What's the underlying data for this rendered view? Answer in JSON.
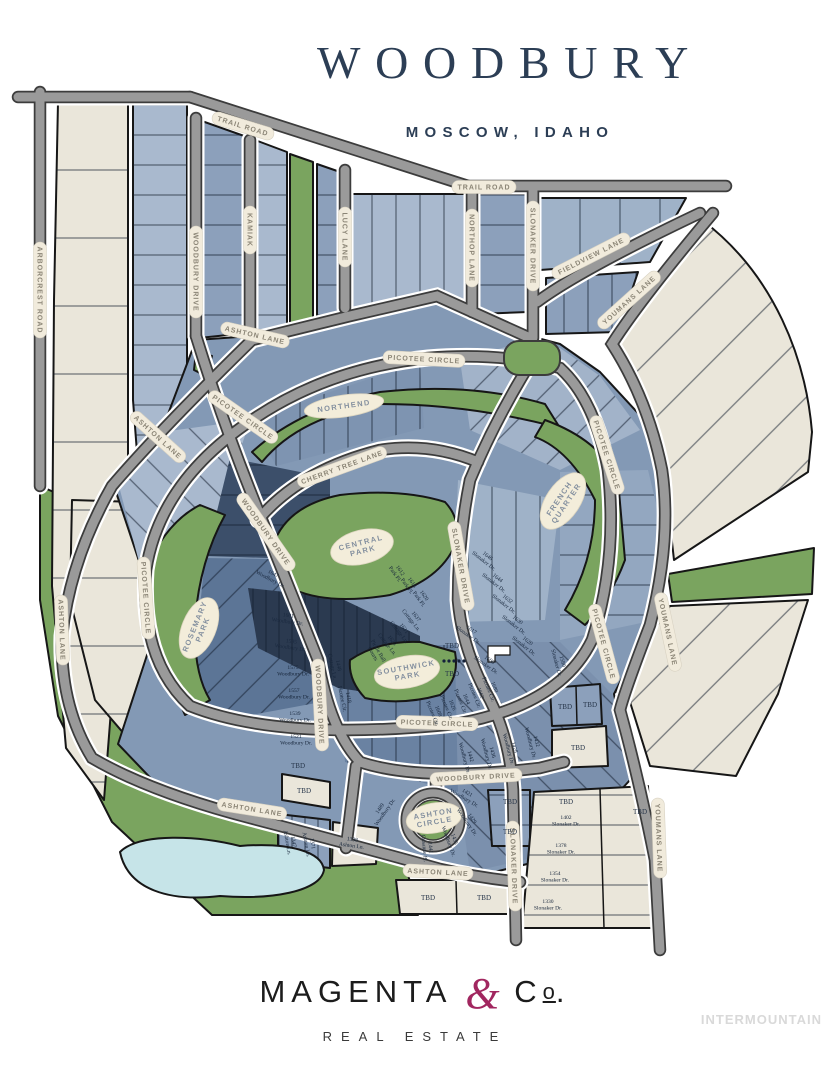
{
  "header": {
    "title": "WOODBURY",
    "location": "MOSCOW, IDAHO"
  },
  "brand": {
    "magenta": "MAGENTA",
    "amp": "&",
    "c": "C",
    "o": "o",
    "period": ".",
    "tagline": "REAL ESTATE"
  },
  "watermark": "INTERMOUNTAIN",
  "colors": {
    "navy_title": "#2c3e55",
    "magenta_accent": "#a1265f",
    "park_green": "#7aa45f",
    "cream_lot": "#eae6da",
    "road_gray": "#9a9a9a",
    "pond_blue": "#c6e4e8",
    "lot_blue_light": "#a9b9ce",
    "lot_blue_mid": "#8399b5",
    "lot_blue_dark": "#3c4f6a",
    "lot_blue_darkest": "#2b3a50"
  },
  "map": {
    "streets": [
      {
        "t": "TRAIL ROAD"
      },
      {
        "t": "TRAIL ROAD"
      },
      {
        "t": "ARBORCREST ROAD"
      },
      {
        "t": "WOODBURY DRIVE"
      },
      {
        "t": "KAMIAK"
      },
      {
        "t": "LUCY LANE"
      },
      {
        "t": "NORTHOP LANE"
      },
      {
        "t": "SLONAKER DRIVE"
      },
      {
        "t": "FIELDVIEW LANE"
      },
      {
        "t": "YOUMANS LANE"
      },
      {
        "t": "ASHTON LANE"
      },
      {
        "t": "ASHTON LANE"
      },
      {
        "t": "PICOTEE CIRCLE"
      },
      {
        "t": "PICOTEE CIRCLE"
      },
      {
        "t": "PICOTEE CIRCLE"
      },
      {
        "t": "PICOTEE CIRCLE"
      },
      {
        "t": "PICOTEE CIRCLE"
      },
      {
        "t": "PICOTEE CIRCLE"
      },
      {
        "t": "CHERRY TREE LANE"
      },
      {
        "t": "WOODBURY DRIVE"
      },
      {
        "t": "WOODBURY DRIVE"
      },
      {
        "t": "WOODBURY DRIVE"
      },
      {
        "t": "SLONAKER DRIVE"
      },
      {
        "t": "SLONAKER DRIVE"
      },
      {
        "t": "YOUMANS LANE"
      },
      {
        "t": "YOUMANS LANE"
      },
      {
        "t": "ASHTON LANE"
      },
      {
        "t": "ASHTON LANE"
      },
      {
        "t": "ASHTON LANE"
      }
    ],
    "parks": [
      {
        "t": "NORTHEND"
      },
      {
        "t": "CENTRAL\nPARK"
      },
      {
        "t": "FRENCH\nQUARTER"
      },
      {
        "t": "ROSEMARY\nPARK"
      },
      {
        "t": "SOUTHWICK\nPARK"
      },
      {
        "t": "ASHTON\nCIRCLE"
      }
    ],
    "lots": [
      {
        "t": "1647\nWoodbury Dr."
      },
      {
        "t": "1601\nWoodbury Dr."
      },
      {
        "t": "1595\nWoodbury Dr."
      },
      {
        "t": "1575\nWoodbury Dr."
      },
      {
        "t": "1557\nWoodbury Dr."
      },
      {
        "t": "1539\nWoodbury Dr."
      },
      {
        "t": "1521\nWoodbury Dr."
      },
      {
        "t": "TBD"
      },
      {
        "t": "1646\nSlonaker Dr."
      },
      {
        "t": "1644\nSlonaker Dr."
      },
      {
        "t": "1632\nSlonaker Dr."
      },
      {
        "t": "1630\nSlonaker Dr."
      },
      {
        "t": "1620\nSlonaker Dr."
      },
      {
        "t": "1617\nSlonaker Dr."
      },
      {
        "t": "1608\nSlonaker Dr."
      },
      {
        "t": "TBD"
      },
      {
        "t": "TBD"
      },
      {
        "t": "1612\nPark Pl."
      },
      {
        "t": "1616\nPark Pl."
      },
      {
        "t": "1620\nPark Pl."
      },
      {
        "t": "1637\nCottage Ln."
      },
      {
        "t": "1631\nCottage Ln."
      },
      {
        "t": "1625\nCottage Ln."
      },
      {
        "t": "Pickle Ball\nCourts"
      },
      {
        "t": "1448\nCottage Ln."
      },
      {
        "t": "1418\nPicotee Cir."
      },
      {
        "t": "1680\nPicotee Cir."
      },
      {
        "t": "1662\nPicotee Cir."
      },
      {
        "t": "1644\nPicotee Cir."
      },
      {
        "t": "1626\nPicotee Cir."
      },
      {
        "t": "1608\nPicotee Cir."
      },
      {
        "t": "1580\nSlonaker Dr."
      },
      {
        "t": "1432\nWoodbury Dr."
      },
      {
        "t": "1428\nWoodbury Dr."
      },
      {
        "t": "1436\nWoodbury Dr."
      },
      {
        "t": "1442\nWoodbury Dr."
      },
      {
        "t": "1489\nWoodbury Dr."
      },
      {
        "t": "1429\nWoodbury Dr."
      },
      {
        "t": "1421\nWoodbury Dr."
      },
      {
        "t": "1435\nWoodbury Dr."
      },
      {
        "t": "1441\nCrisanne Pl."
      },
      {
        "t": "1347\nAshton Ln."
      },
      {
        "t": "1371\nAshton Ln."
      },
      {
        "t": "1398\nAshton Ln."
      },
      {
        "t": "TBD"
      },
      {
        "t": "TBD"
      },
      {
        "t": "TBD"
      },
      {
        "t": "TBD"
      },
      {
        "t": "1402\nSlonaker Dr."
      },
      {
        "t": "1378\nSlonaker Dr."
      },
      {
        "t": "1354\nSlonaker Dr."
      },
      {
        "t": "1330\nSlonaker Dr."
      },
      {
        "t": "TBD"
      },
      {
        "t": "TBD"
      },
      {
        "t": "TBD"
      },
      {
        "t": "TBD"
      },
      {
        "t": "TBD"
      },
      {
        "t": "TBD"
      }
    ]
  }
}
